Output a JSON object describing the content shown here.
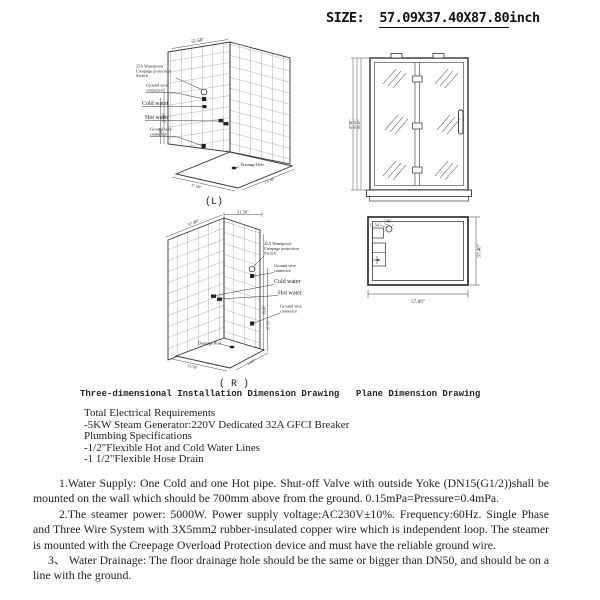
{
  "header": {
    "size_prefix": "SIZE:",
    "size_numbers": "57.09X37.40X87.80",
    "size_unit": "inch"
  },
  "captions": {
    "three_d": "Three-dimensional Installation Dimension Drawing",
    "plane": "Plane Dimension Drawing",
    "left_view": "(L)",
    "right_view": "( R )"
  },
  "drawing_labels": {
    "switch_l1": "25A Waterproof",
    "switch_l2": "Creepage protection",
    "switch_l3": "Switch",
    "ground_l1": "Ground wire",
    "ground_l2": "connector",
    "cold": "Cold water",
    "hot": "Hot water",
    "drain": "Drainage Hole"
  },
  "dims": {
    "l_top": "51.60\"",
    "l_side_a": "27.55\"",
    "l_side_b": "7.87\"",
    "l_floor_left": "17.60\"",
    "l_floor_right": "13.78\"",
    "r_top": "31.50\"",
    "r_wall": "37.40\"",
    "r_side_a": "39.06\"",
    "r_side_b": "27.55\"",
    "r_floor_left": "13.78\"",
    "r_floor_right": "5.40\"",
    "front_a": "87.80\"",
    "front_b": "85.43\"",
    "front_c": "81.10\"",
    "plane_width": "57.09\"",
    "plane_depth": "37.40\"",
    "plane_off_a": "11.54\"",
    "plane_off_b": "7.66\""
  },
  "specs": {
    "electrical_title": "Total Electrical Requirements",
    "electrical_item": "-5KW Steam Generator:220V Dedicated 32A GFCI Breaker",
    "plumbing_title": "Plumbing Specifications",
    "plumbing_item1": "-1/2\"Flexible Hot and Cold Water Lines",
    "plumbing_item2": "-1 1/2\"Flexible Hose Drain"
  },
  "notes": {
    "p1": "1.Water Supply: One Cold and one Hot pipe. Shut-off Valve with outside Yoke (DN15(G1/2))shall be mounted on the wall which should be 700mm above from the ground. 0.15mPa=Pressure=0.4mPa.",
    "p2": "2.The steamer power: 5000W. Power supply voltage:AC230V±10%. Frequency:60Hz. Single Phase and Three Wire System with 3X5mm2 rubber-insulated copper wire which is independent loop. The steamer is mounted with the Creepage Overload Protection device and must have the reliable ground wire.",
    "p3": "3、 Water Drainage: The floor drainage hole should be the same or bigger than DN50, and should be on a line with the ground."
  }
}
